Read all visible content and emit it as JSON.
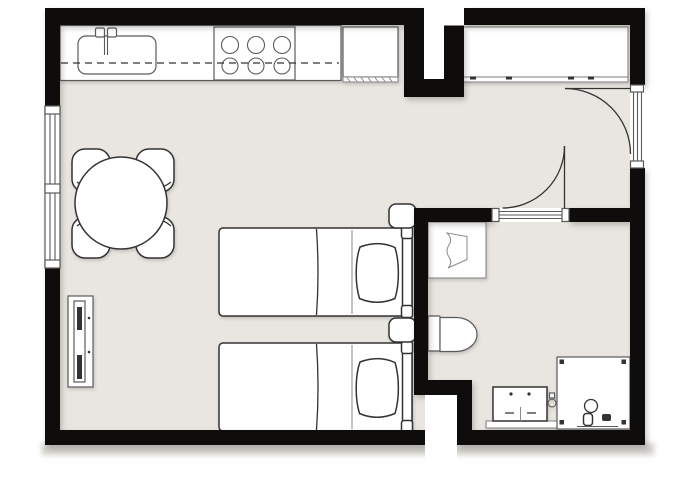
{
  "scene": {
    "type": "architectural floor plan, top-down view",
    "style": "black walls, white fixtures with thin gray outlines on warm gray floor, white exterior"
  },
  "colors": {
    "background": "#ffffff",
    "floor": "#e9e6e1",
    "wall": "#0e0d0b",
    "fixture_fill": "#ffffff",
    "stroke_dark": "#333333",
    "stroke_mid": "#5a5a5a",
    "stroke_light": "#8a8a8a",
    "shadow_band": "#cfcdc8"
  },
  "rooms": [
    {
      "name": "main-living-bedroom",
      "position": "left two thirds",
      "fixtures": [
        "kitchen-counter",
        "kitchen-sink",
        "stove",
        "kitchen-unit",
        "dining-table",
        "dining-chairs",
        "window",
        "tv-stand",
        "bed-1",
        "bed-2",
        "nightstand-1",
        "nightstand-2"
      ]
    },
    {
      "name": "entry-hall",
      "position": "top right",
      "fixtures": [
        "closet",
        "entry-door",
        "interior-door"
      ]
    },
    {
      "name": "bathroom",
      "position": "bottom right",
      "fixtures": [
        "washbasin-counter",
        "toilet",
        "vanity-cabinet",
        "tap-fixture",
        "shower"
      ]
    }
  ],
  "counts": {
    "stove_burners": 6,
    "dining_chairs": 4,
    "beds": 2,
    "pillows": 2,
    "nightstands": 2,
    "doors": 2,
    "door_swing_arcs": 2,
    "windows": 1,
    "closet_door_handles": 4,
    "shower_corner_markers": 4
  }
}
